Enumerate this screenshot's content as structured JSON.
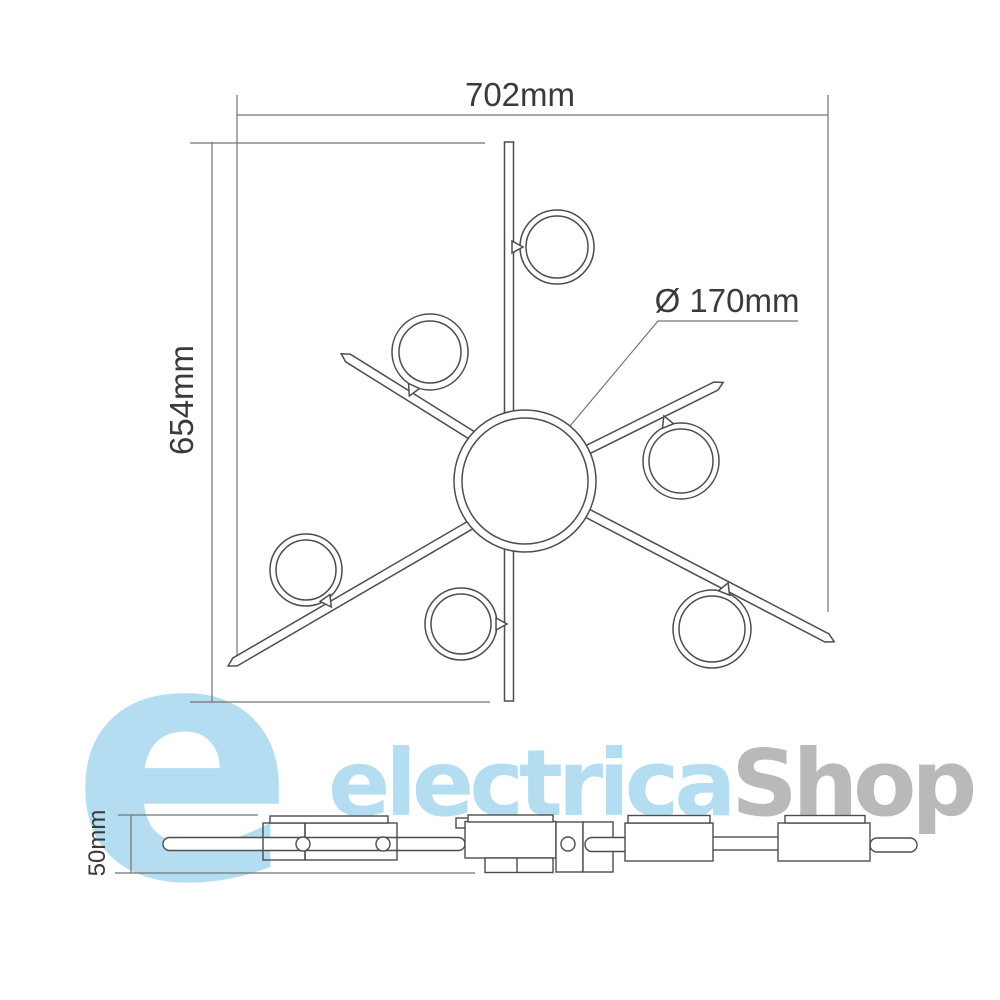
{
  "drawing": {
    "dim_width": "702mm",
    "dim_height": "654mm",
    "dim_diameter": "Ø 170mm",
    "dim_profile_height": "50mm"
  },
  "logo": {
    "emblem": "e",
    "name_primary": "electrica",
    "name_secondary": "Shop",
    "primary_color": "#b5ddf2",
    "secondary_color": "#b7b9bb"
  },
  "style": {
    "line_color": "#4d4d4d",
    "dim_line_color": "#757575",
    "text_color": "#3a3a3a"
  }
}
